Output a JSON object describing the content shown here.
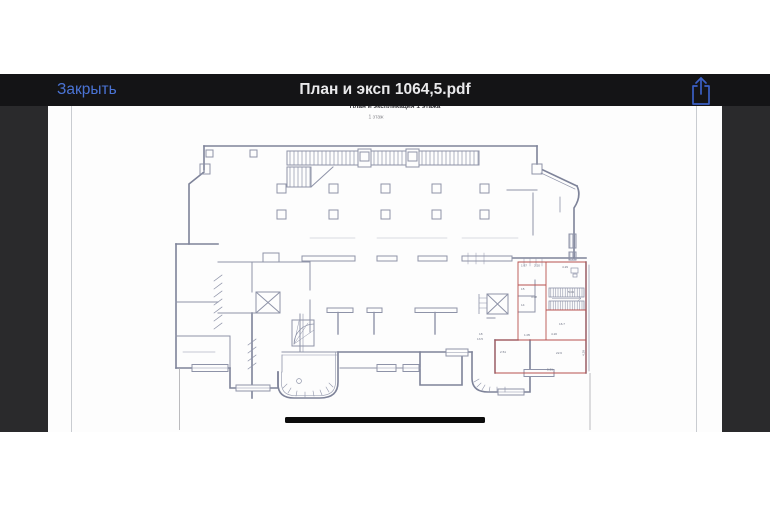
{
  "navbar": {
    "close_label": "Закрыть",
    "title": "План и эксп 1064,5.pdf",
    "share_icon": "ios-share-icon"
  },
  "page": {
    "cut_header_text": "План и экспликация 1 этажа",
    "floor_caption": "1 этаж"
  },
  "plan": {
    "labels": [
      {
        "text": "4.29"
      },
      {
        "text": "5.04"
      },
      {
        "text": "15"
      },
      {
        "text": "14"
      },
      {
        "text": "3.08"
      },
      {
        "text": "1.67"
      },
      {
        "text": "2.20"
      },
      {
        "text": "16.7"
      },
      {
        "text": "4.20"
      },
      {
        "text": "1.05"
      },
      {
        "text": "22.6"
      },
      {
        "text": "5.51"
      },
      {
        "text": "4.28"
      },
      {
        "text": "2.51"
      },
      {
        "text": "13.5"
      },
      {
        "text": "18"
      }
    ]
  },
  "colors": {
    "accent_blue": "#4a73d4",
    "navbar_bg": "#141416",
    "viewer_bg": "#2a2a2c",
    "page_bg": "#fdfdfd",
    "plan_line": "#8e93a8",
    "highlight_red": "#b8514e",
    "redaction_bar": "#0c0c0c"
  }
}
